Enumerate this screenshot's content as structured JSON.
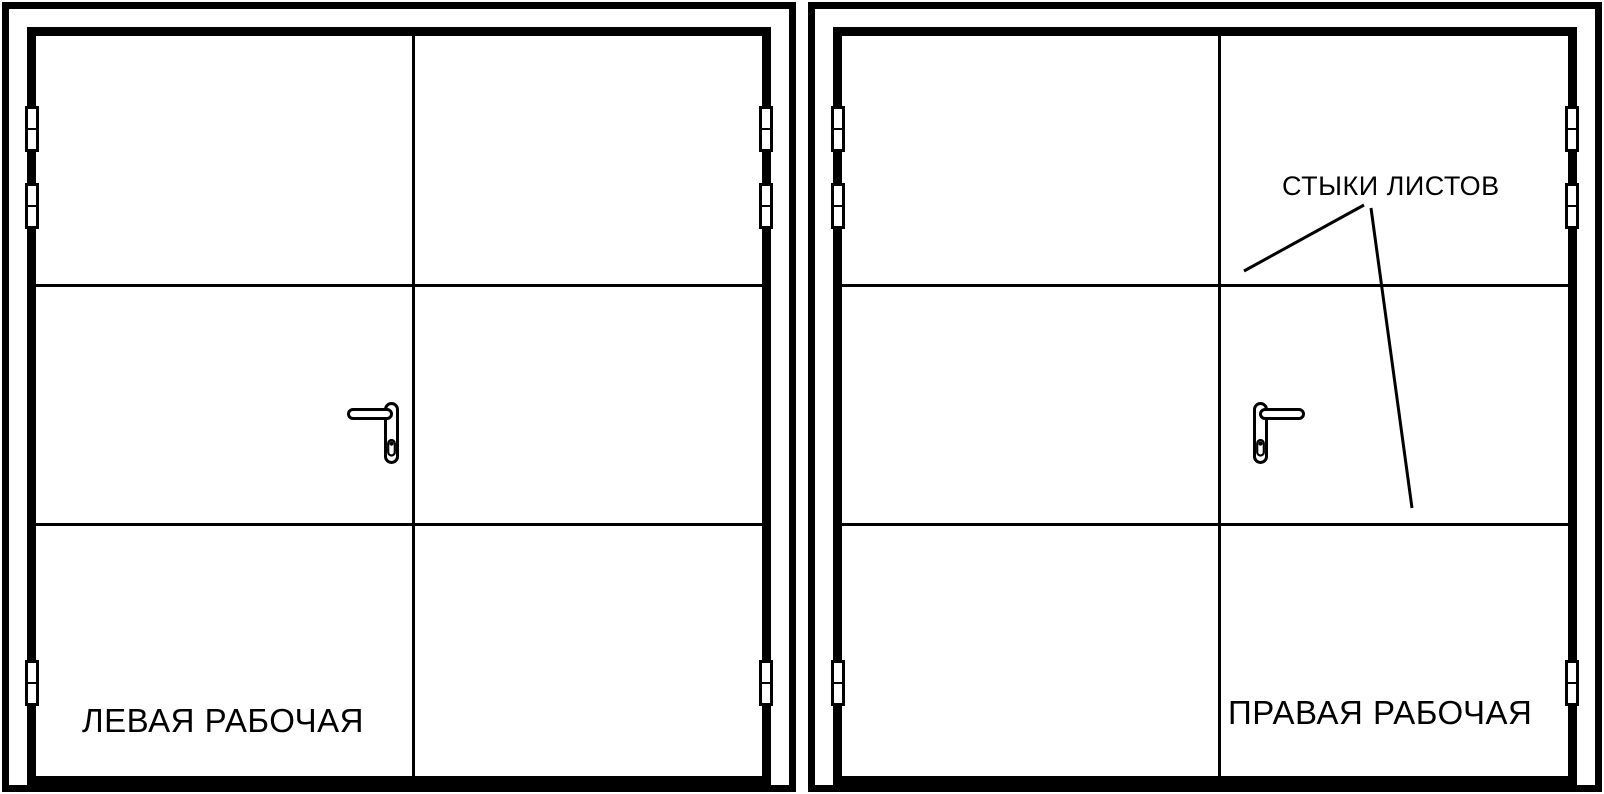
{
  "drawing": {
    "type": "door-technical-drawing",
    "colors": {
      "line": "#000000",
      "background": "#ffffff"
    }
  },
  "diagrams": [
    {
      "id": "left-active-door",
      "label": "ЛЕВАЯ РАБОЧАЯ",
      "active_leaf": "left",
      "leaves": 2,
      "sheet_rows": 3,
      "hinges_per_side": 3
    },
    {
      "id": "right-active-door",
      "label": "ПРАВАЯ РАБОЧАЯ",
      "active_leaf": "right",
      "leaves": 2,
      "sheet_rows": 3,
      "hinges_per_side": 3,
      "annotation": "СТЫКИ ЛИСТОВ"
    }
  ]
}
